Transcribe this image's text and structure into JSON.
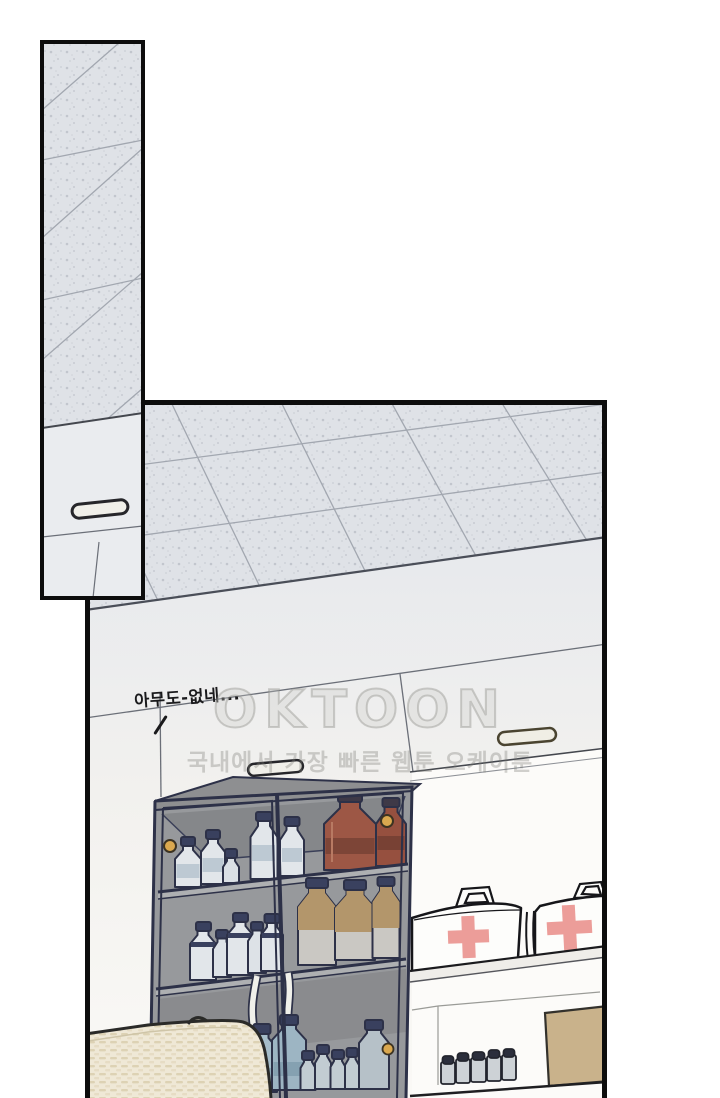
{
  "scene": {
    "speech_text": "아무도-없네...",
    "watermark_title": "OKTOON",
    "watermark_subtitle": "국내에서 가장 빠른 웹툰 오케이툰"
  },
  "panels": [
    {
      "id": "ceiling-strip-panel"
    },
    {
      "id": "storage-room-panel"
    }
  ],
  "colors": {
    "panel_border": "#0d0d0d",
    "ceiling_tile": "#dfe2e7",
    "ceiling_grid_line": "#a2a7b0",
    "wall_light": "#eef0f2",
    "cabinet_outline": "#2d3148",
    "cabinet_interior": "#97999c",
    "amber_bottle": "#9d5745",
    "tan_bottle_shoulder": "#b3966b",
    "white_bottle": "#e2e6ea",
    "blue_bottle": "#a6bdca",
    "knob_gold": "#daa84f",
    "first_aid_cross": "#ec9d99",
    "cardboard_box": "#c9b28b",
    "wicker_basket": "#efe8d6"
  }
}
